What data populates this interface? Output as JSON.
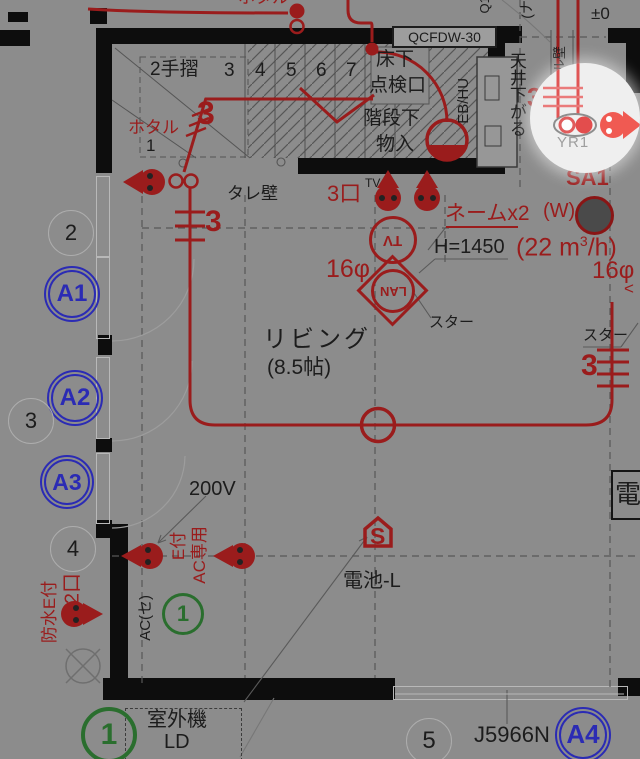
{
  "colors": {
    "paper": "#8c8c8c",
    "wall": "#0d0d0d",
    "wire_red": "#9a1c1c",
    "window_blue": "#2b2bb4",
    "note_green": "#2a6e2e",
    "spotlight": "#efefef",
    "bright_red": "#ef5350"
  },
  "labels": {
    "top": {
      "hotaru_fragment": "ホタル",
      "q_fragment": "Q1",
      "paren_fragment": "(ナ",
      "plus_minus": "±0",
      "box_label": "QCFDW-30"
    },
    "stair": {
      "handrail": "2手摺",
      "steps": [
        "3",
        "4",
        "5",
        "6",
        "7"
      ],
      "step1": "1",
      "hotaru": "ホタル",
      "wires3": "3",
      "underfloor1": "床下",
      "underfloor2": "点検口",
      "closet1": "階段下",
      "closet2": "物入",
      "equipment": "EB/HU"
    },
    "right_top": {
      "ceiling_note": "天井下がる",
      "wall_note": "Sクル壁",
      "fixture": "YR1",
      "supply": "SA1",
      "w": "(W)",
      "airflow_a": "(22 m",
      "airflow_sup": "3",
      "airflow_b": "/h)",
      "pipe": "16φ",
      "wires3": "3"
    },
    "center": {
      "outlets": "3口",
      "tv_small": "TV",
      "name": "ネームx2",
      "height": "H=1450",
      "tv": "TV",
      "lan": "LAN",
      "pipe": "16φ",
      "star": "スター",
      "room": "リビング",
      "size": "(8.5帖)",
      "wall": "タレ壁",
      "wires3": "3"
    },
    "right": {
      "star": "スター",
      "wires3": "3",
      "chevron": "<",
      "den": "電"
    },
    "left": {
      "n2": "2",
      "n3": "3",
      "n4": "4",
      "a1": "A1",
      "a2": "A2",
      "a3": "A3",
      "waterproof": "防水E付",
      "ports2": "2口"
    },
    "bottom": {
      "volt": "200V",
      "e": "E付",
      "ac_only": "AC専用",
      "ac_se": "AC(セ)",
      "circ1": "1",
      "sensor": "S",
      "battery": "電池-L",
      "outdoor": "室外機",
      "ld": "LD",
      "circ1b": "1",
      "n5": "5",
      "code": "J5966N",
      "a4": "A4"
    }
  }
}
